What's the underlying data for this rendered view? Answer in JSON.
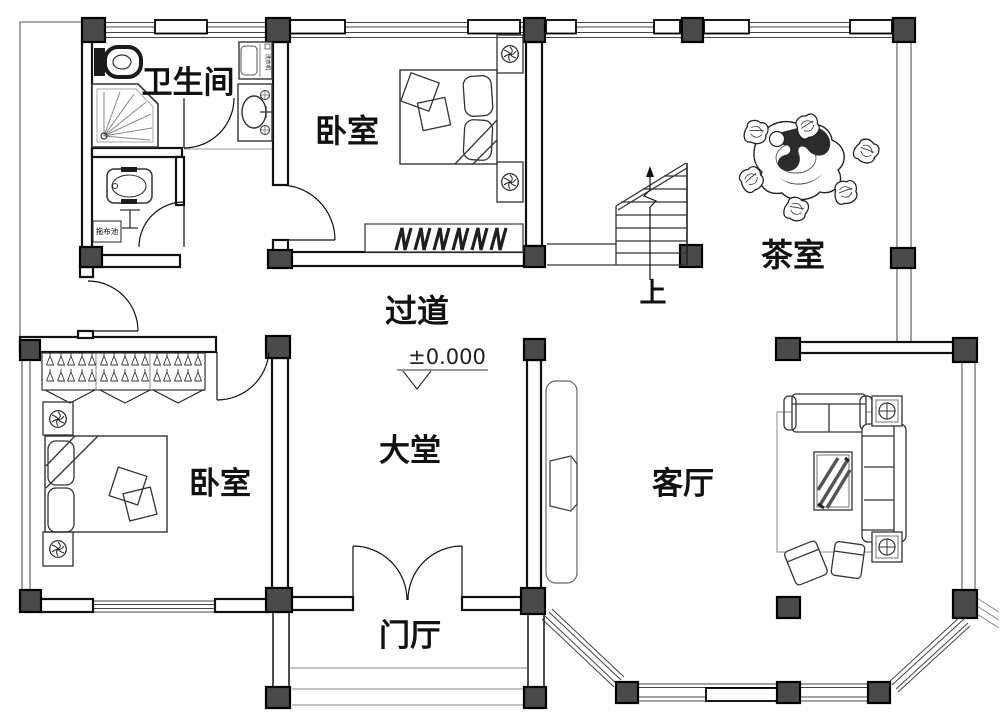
{
  "page": {
    "type": "architectural-floor-plan",
    "background": "#ffffff"
  },
  "labels": {
    "bathroom": "卫生间",
    "bedroom_top": "卧室",
    "bedroom_left": "卧室",
    "corridor": "过道",
    "tea_room": "茶室",
    "hall": "大堂",
    "living_room": "客厅",
    "entrance_hall": "门厅",
    "stairs_up": "上",
    "elevation": "±0.000",
    "mop_pool": "拖布池",
    "washing_machine": "洗衣机"
  },
  "colors": {
    "line": "#111111",
    "column_fill": "#4a4a4a",
    "furniture_line": "#333333",
    "light_line": "#999999",
    "text": "#111111"
  }
}
